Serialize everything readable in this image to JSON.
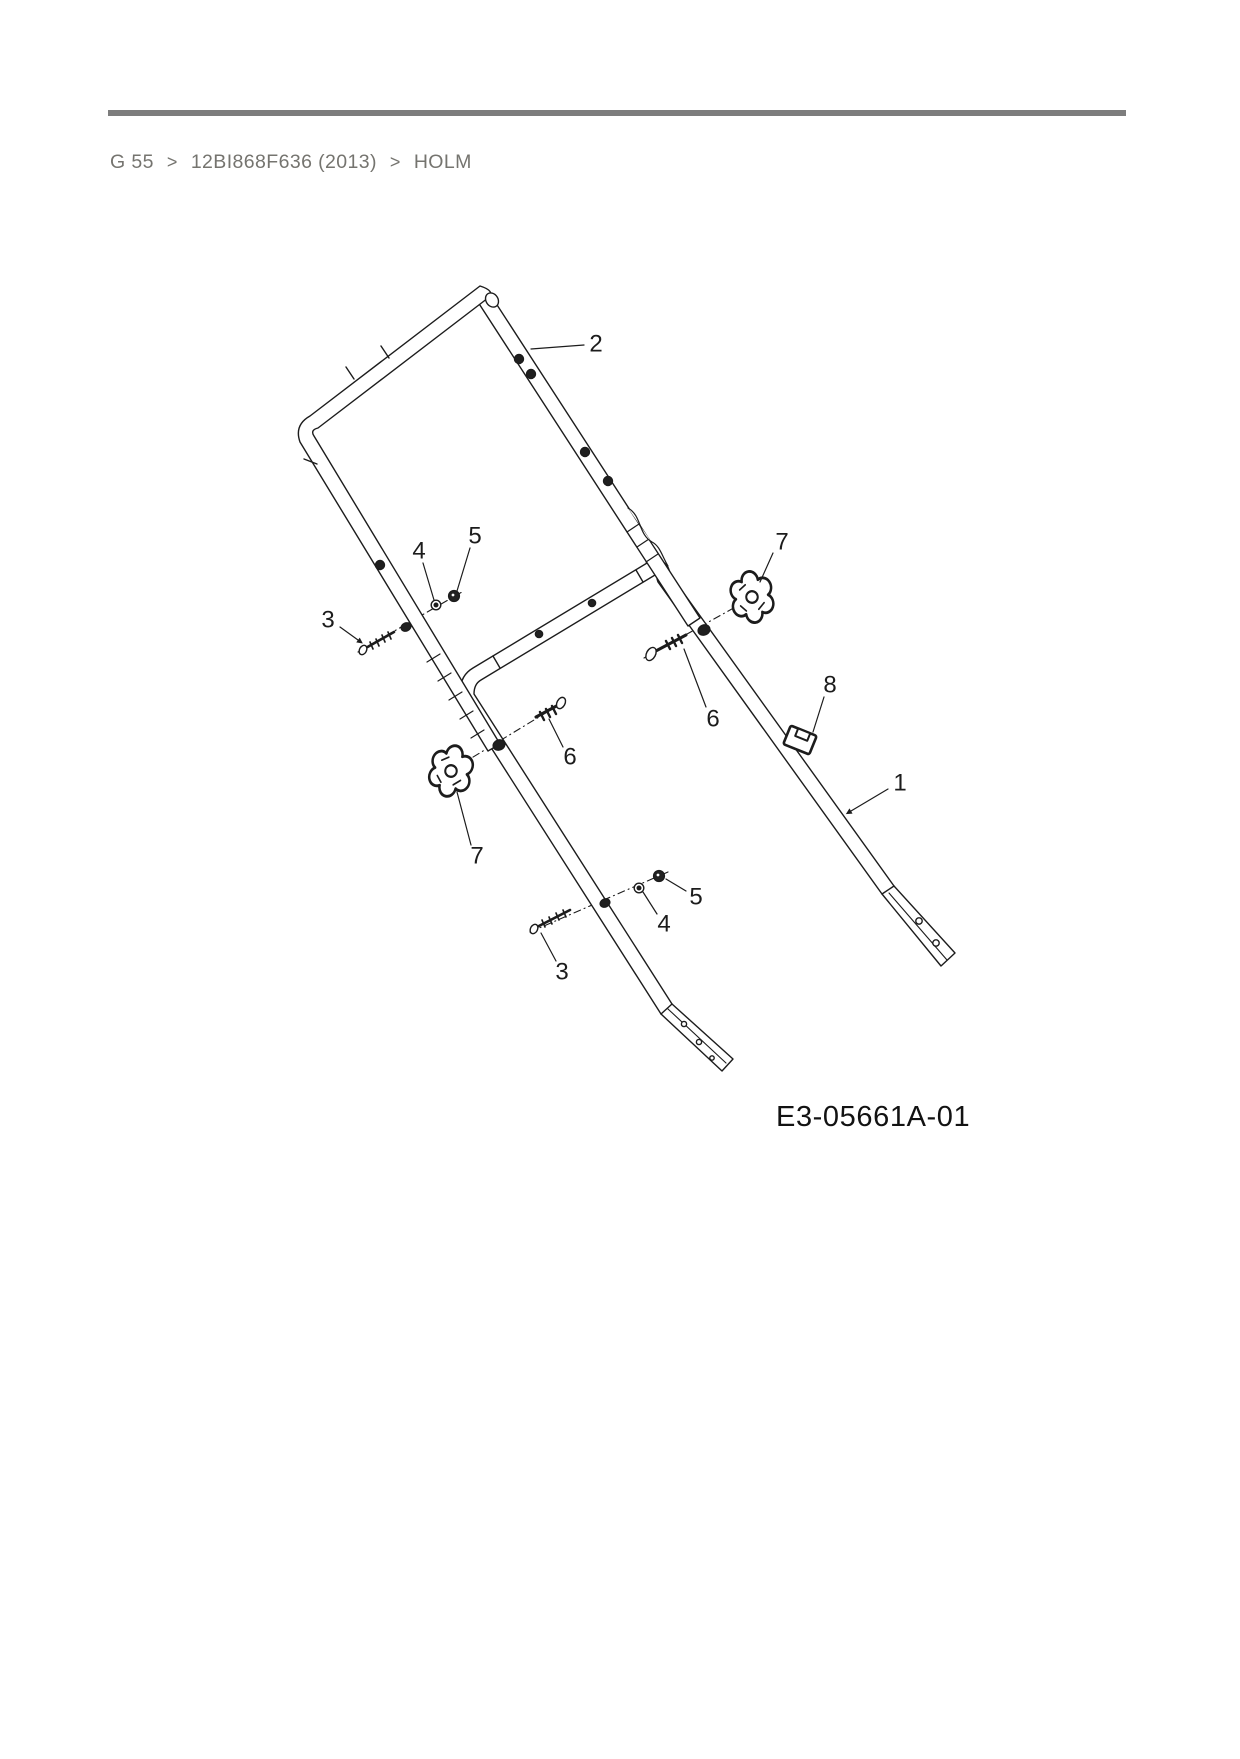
{
  "breadcrumb": {
    "separator": ">",
    "items": [
      {
        "label": "G 55"
      },
      {
        "label": "12BI868F636 (2013)"
      },
      {
        "label": "HOLM"
      }
    ]
  },
  "diagram": {
    "code": "E3-05661A-01",
    "callouts": [
      {
        "ref": "2",
        "x": 596,
        "y": 344,
        "leader": [
          [
            584,
            345
          ],
          [
            531,
            349
          ]
        ],
        "arrow": false
      },
      {
        "ref": "3",
        "x": 328,
        "y": 620,
        "leader": [
          [
            340,
            627
          ],
          [
            358,
            640
          ]
        ],
        "arrow": true
      },
      {
        "ref": "4",
        "x": 419,
        "y": 551,
        "leader": [
          [
            423,
            563
          ],
          [
            434,
            600
          ]
        ],
        "arrow": false
      },
      {
        "ref": "5",
        "x": 475,
        "y": 536,
        "leader": [
          [
            470,
            548
          ],
          [
            457,
            591
          ]
        ],
        "arrow": false
      },
      {
        "ref": "7",
        "x": 782,
        "y": 542,
        "leader": [
          [
            773,
            553
          ],
          [
            760,
            582
          ]
        ],
        "arrow": false
      },
      {
        "ref": "6",
        "x": 713,
        "y": 719,
        "leader": [
          [
            706,
            707
          ],
          [
            684,
            649
          ]
        ],
        "arrow": false
      },
      {
        "ref": "8",
        "x": 830,
        "y": 685,
        "leader": [
          [
            824,
            697
          ],
          [
            813,
            732
          ]
        ],
        "arrow": false
      },
      {
        "ref": "1",
        "x": 900,
        "y": 783,
        "leader": [
          [
            888,
            789
          ],
          [
            851,
            811
          ]
        ],
        "arrow": true
      },
      {
        "ref": "6",
        "x": 570,
        "y": 757,
        "leader": [
          [
            563,
            747
          ],
          [
            549,
            719
          ]
        ],
        "arrow": false
      },
      {
        "ref": "7",
        "x": 477,
        "y": 856,
        "leader": [
          [
            471,
            845
          ],
          [
            457,
            792
          ]
        ],
        "arrow": false
      },
      {
        "ref": "5",
        "x": 696,
        "y": 897,
        "leader": [
          [
            686,
            891
          ],
          [
            666,
            879
          ]
        ],
        "arrow": false
      },
      {
        "ref": "4",
        "x": 664,
        "y": 924,
        "leader": [
          [
            657,
            914
          ],
          [
            643,
            892
          ]
        ],
        "arrow": false
      },
      {
        "ref": "3",
        "x": 562,
        "y": 972,
        "leader": [
          [
            556,
            961
          ],
          [
            541,
            933
          ]
        ],
        "arrow": false
      }
    ]
  },
  "colors": {
    "line": "#1c1c1c",
    "rule": "#7d7d7d",
    "breadcrumb_text": "#75746f",
    "code_text": "#121212"
  }
}
